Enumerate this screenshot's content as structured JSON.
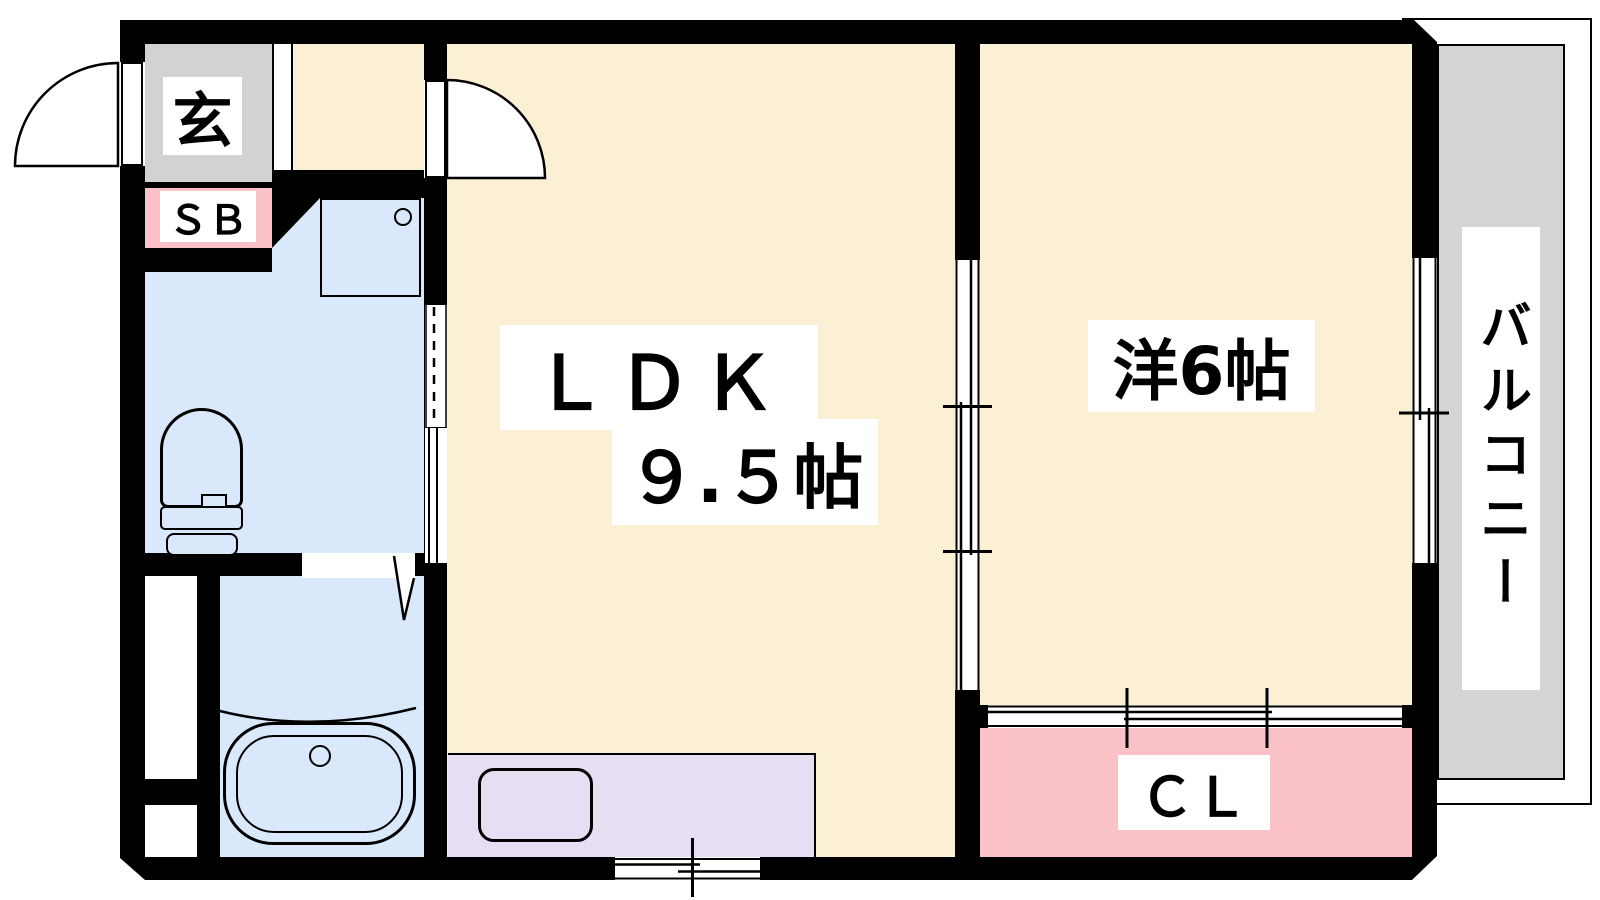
{
  "floorplan": {
    "rooms": {
      "entrance": {
        "label": "玄"
      },
      "shoe_box": {
        "label": "ＳＢ"
      },
      "ldk": {
        "name_line": "ＬＤＫ",
        "size_line": "９.５帖"
      },
      "western_room": {
        "label": "洋6帖"
      },
      "closet": {
        "label": "ＣＬ"
      },
      "balcony": {
        "label": "バルコニー"
      }
    },
    "palette": {
      "wall": "#000000",
      "floor_cream": "#fbf0d3",
      "water_blue": "#d9e8fa",
      "kitchen_purple": "#e7def3",
      "storage_pink": "#fac2c7",
      "entrance_gray": "#d2d2d2",
      "balcony_gray": "#d5d5d5",
      "label_bg": "#ffffff"
    }
  }
}
